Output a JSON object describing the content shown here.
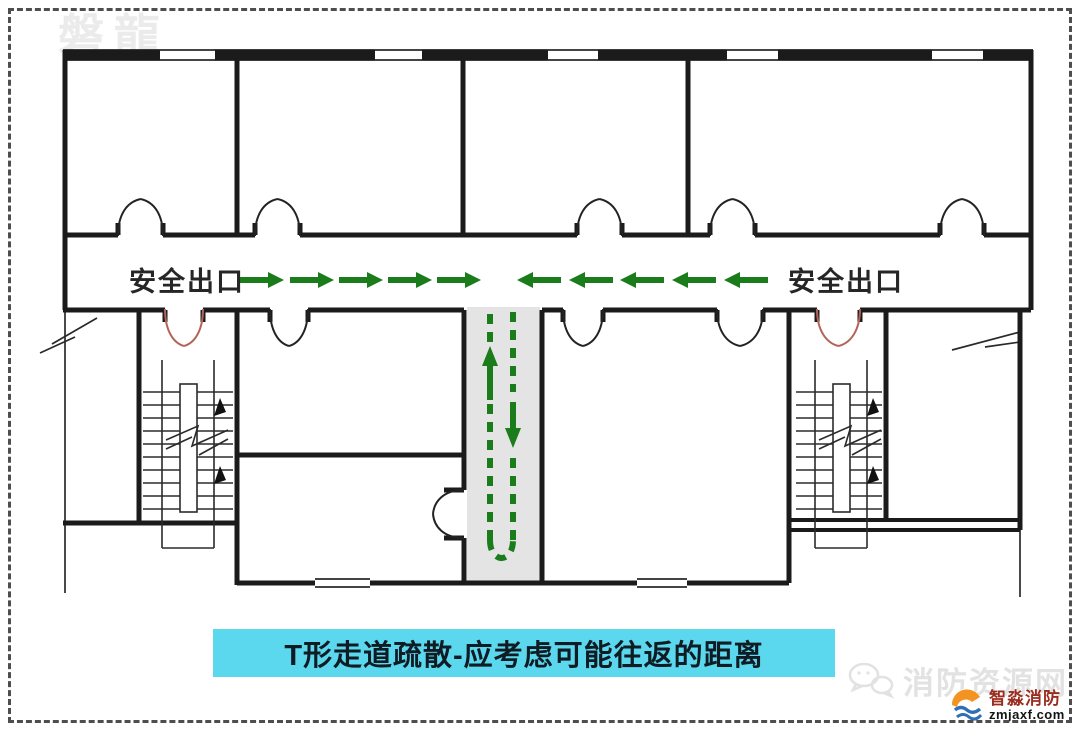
{
  "colors": {
    "wall": "#1b1b1b",
    "thin_line": "#2a2a2a",
    "green": "#1a7c1a",
    "red_door": "#b4635a",
    "corridor_fill": "#e4e4e4",
    "caption_bg": "#5bd8ee",
    "caption_text": "#0f1c24",
    "label_text": "#262626",
    "watermark": "#ebebeb",
    "watermark_strong": "#e2e2e2",
    "logo_red": "#9b2d1f",
    "logo_blue": "#2e6fb5",
    "logo_orange": "#f39321"
  },
  "watermarks": {
    "top_left": "磐龍",
    "bottom_right": "消防资源网"
  },
  "plan": {
    "exit_label_left": "安全出口",
    "exit_label_right": "安全出口",
    "corridor_arrows": {
      "left_group_centers": [
        262,
        312,
        361,
        410,
        459
      ],
      "right_group_centers": [
        539,
        591,
        642,
        694,
        746
      ],
      "y": 280
    }
  },
  "caption": {
    "text": "T形走道疏散-应考虑可能往返的距离"
  },
  "logo": {
    "brand": "智淼消防",
    "domain": "zmjaxf.com"
  }
}
